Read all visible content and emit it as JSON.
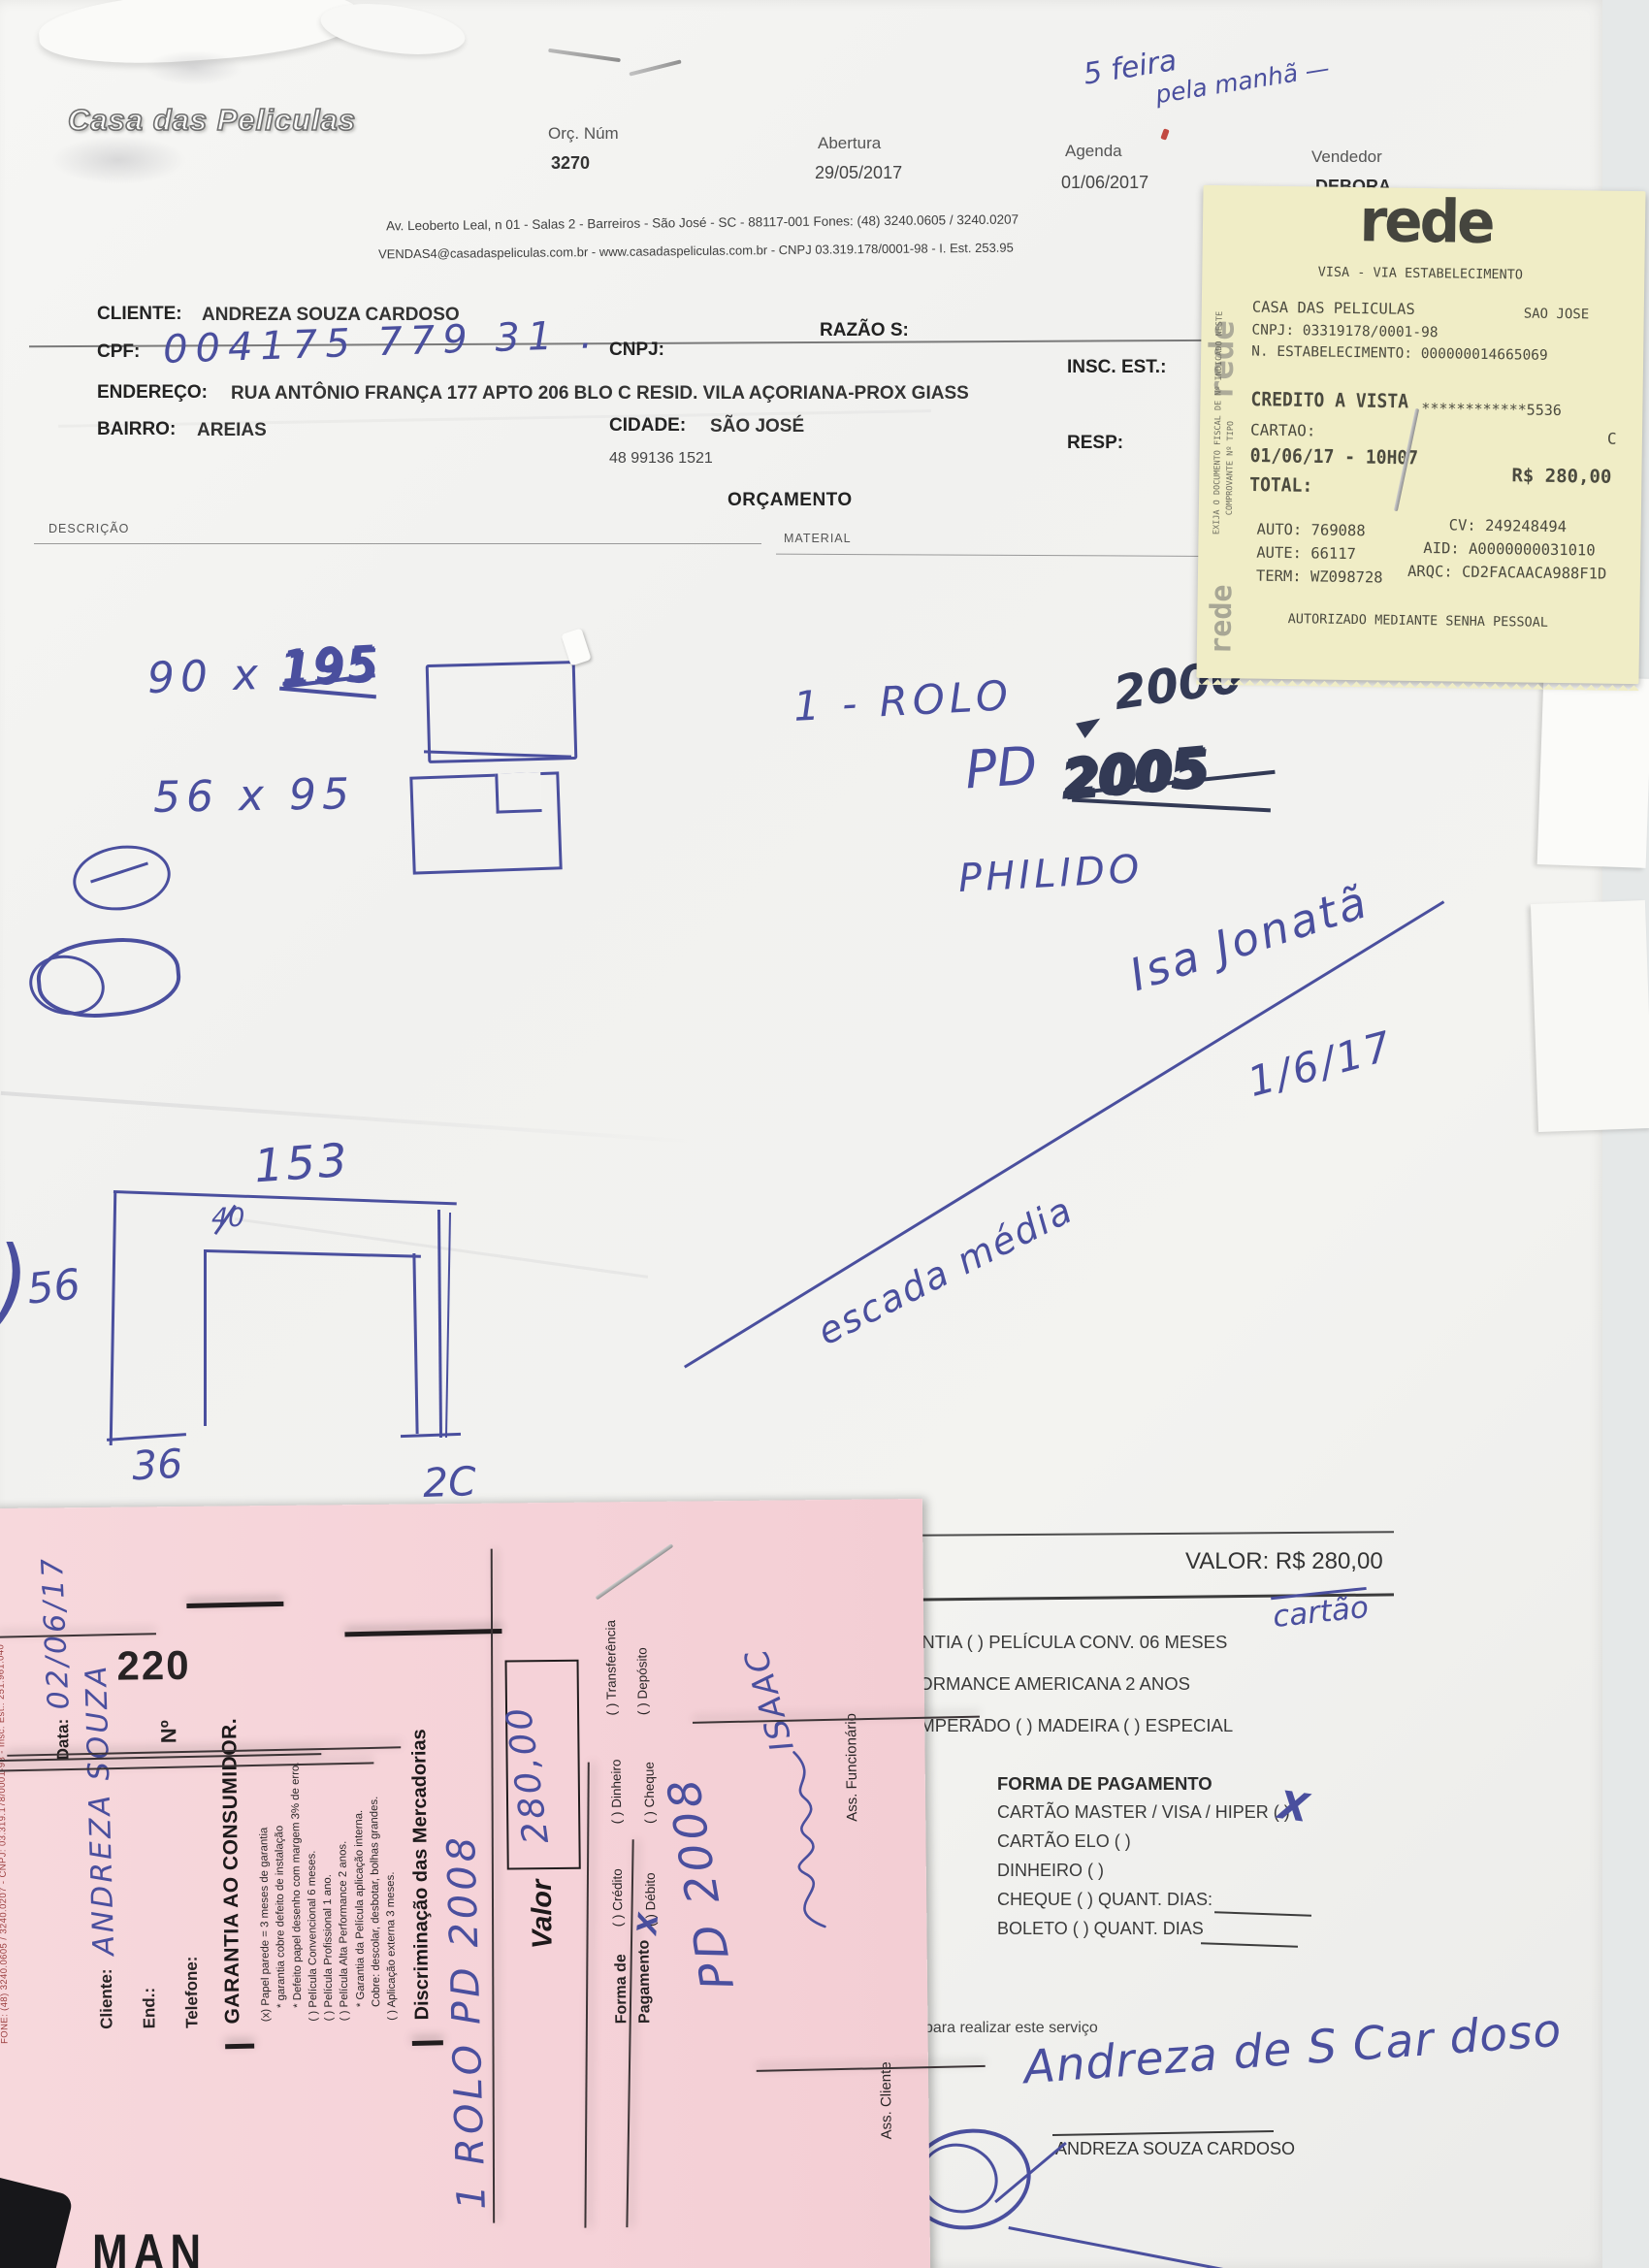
{
  "colors": {
    "ink": "#4a4f9e",
    "ink_dark": "#333a55",
    "receipt_bg": "#f0edc6",
    "pink_bg": "#f6d5da",
    "paper": "#f2f2f0"
  },
  "header": {
    "logo": "Casa das Peliculas",
    "orc_label": "Orç. Núm",
    "orc_value": "3270",
    "abertura_label": "Abertura",
    "abertura_value": "29/05/2017",
    "agenda_label": "Agenda",
    "agenda_value": "01/06/2017",
    "vendedor_label": "Vendedor",
    "vendedor_value": "DEBORA",
    "note1": "5 feira",
    "note2": "pela manhã —"
  },
  "address": {
    "line1": "Av. Leoberto Leal, n 01 - Salas 2 - Barreiros - São José - SC - 88117-001 Fones: (48) 3240.0605 / 3240.0207",
    "line2": "VENDAS4@casadaspeliculas.com.br - www.casadaspeliculas.com.br - CNPJ 03.319.178/0001-98 - I. Est. 253.95"
  },
  "client": {
    "cliente_label": "CLIENTE:",
    "cliente_value": "ANDREZA SOUZA CARDOSO",
    "razao_label": "RAZÃO S:",
    "cpf_label": "CPF:",
    "cpf_value": "004175 779 31 .",
    "cnpj_label": "CNPJ:",
    "insc_label": "INSC. EST.:",
    "endereco_label": "ENDEREÇO:",
    "endereco_value": "RUA ANTÔNIO FRANÇA 177 APTO 206 BLO C RESID. VILA AÇORIANA-PROX GIASS",
    "bairro_label": "BAIRRO:",
    "bairro_value": "AREIAS",
    "cidade_label": "CIDADE:",
    "cidade_value": "SÃO JOSÉ",
    "resp_label": "RESP:",
    "phone": "48 99136 1521"
  },
  "order": {
    "title": "ORÇAMENTO",
    "descricao": "DESCRIÇÃO",
    "material": "MATERIAL"
  },
  "receipt": {
    "brand": "rede",
    "via": "VISA - VIA ESTABELECIMENTO",
    "merchant": "CASA DAS PELICULAS",
    "city": "SAO JOSE",
    "cnpj": "CNPJ: 03319178/0001-98",
    "estab": "N. ESTABELECIMENTO: 000000014665069",
    "tipo": "CREDITO A VISTA",
    "card_mask": "************5536",
    "cartao_label": "CARTAO:",
    "card_flag": "C",
    "datetime": "01/06/17 - 10H07",
    "amount": "R$ 280,00",
    "total_label": "TOTAL:",
    "auto": "AUTO: 769088",
    "cv": "CV: 249248494",
    "aute": "AUTE: 66117",
    "aid": "AID: A0000000031010",
    "term": "TERM: WZ098728",
    "arqc": "ARQC: CD2FACAACA988F1D",
    "footer": "AUTORIZADO MEDIANTE SENHA PESSOAL",
    "edge1": "EXIJA O DOCUMENTO FISCAL DE Nº INDICADO NESTE",
    "edge2": "COMPROVANTE Nº      TIPO"
  },
  "notes": {
    "dim1a": "90 x",
    "dim1b": "195",
    "dim2": "56 x  95",
    "item_line": "1 - ROLO",
    "price": "2000",
    "pd": "PD",
    "pd_scribble": "2005",
    "brand_note": "PHILIDO",
    "sig1": "Isa Jonatã",
    "sig_date": "1/6/17",
    "escada": "escada média"
  },
  "sketch": {
    "w_top": "153",
    "w_mid": "40",
    "bracket": ")",
    "h_left": "56",
    "w_bottom": "36",
    "w_right": "2C"
  },
  "pink": {
    "edge": "FONE: (48) 3240.0605 / 3240.0207 - CNPJ: 03.319.178/0001-98 - Insc. Est.: 251.961.040",
    "data_label": "Data:",
    "data_value": "02/06/17",
    "cliente_label": "Cliente:",
    "cliente_value": "ANDREZA SOUZA",
    "end_label": "End.:",
    "telefone_label": "Telefone:",
    "num_label": "Nº",
    "num_value": "220",
    "title": "GARANTIA AO CONSUMIDOR.",
    "terms": [
      "(x) Papel parede = 3 meses de garantia",
      "* garantia cobre defeito de instalação",
      "* Defeito papel desenho com margem 3% de erro.",
      "(  ) Película Convencional 6 meses.",
      "(  ) Película Profissional 1 ano.",
      "(  ) Película Alta Performance 2 anos.",
      "* Garantia da Película aplicação interna.",
      "Cobre: descolar, desbotar, bolhas grandes.",
      "(  ) Aplicação externa 3 meses."
    ],
    "merc_title": "Discriminação das Mercadorias",
    "merc_hw1": "1 ROLO PD 2008",
    "merc_hw2": "PD 2008",
    "valor_label": "Valor",
    "valor_value": "280,00",
    "forma1": "Forma de",
    "forma2": "Pagamento",
    "cb_credito": "(  ) Crédito",
    "cb_dinheiro": "(  ) Dinheiro",
    "cb_transferencia": "(  ) Transferência",
    "cb_debito": "(  ) Débito",
    "cb_cheque": "(  ) Cheque",
    "cb_deposito": "(  ) Depósito",
    "cb_mark": "X",
    "ass_cliente": "Ass. Cliente",
    "ass_func": "Ass. Funcionário",
    "sig": "ISAAC"
  },
  "payment": {
    "valor": "VALOR: R$ 280,00",
    "cartao_note": "cartão",
    "row1": "ANTIA      (  ) PELÍCULA CONV. 06 MESES",
    "row2": "FORMANCE AMERICANA 2 ANOS",
    "row3": "EMPERADO   (  )  MADEIRA   (  )  ESPECIAL",
    "title": "FORMA DE PAGAMENTO",
    "opt1": "CARTÃO MASTER / VISA / HIPER  (  )",
    "opt1_mark": "X",
    "opt2": "CARTÃO ELO  (  )",
    "opt3": "DINHEIRO  (  )",
    "opt4": "CHEQUE  (  )  QUANT. DIAS:",
    "opt5": "BOLETO  (  )  QUANT. DIAS",
    "servico": "para realizar este serviço",
    "sig_script": "Andreza de S Car doso",
    "sig_name": "ANDREZA SOUZA CARDOSO"
  },
  "misc": {
    "corner": "MAN"
  }
}
